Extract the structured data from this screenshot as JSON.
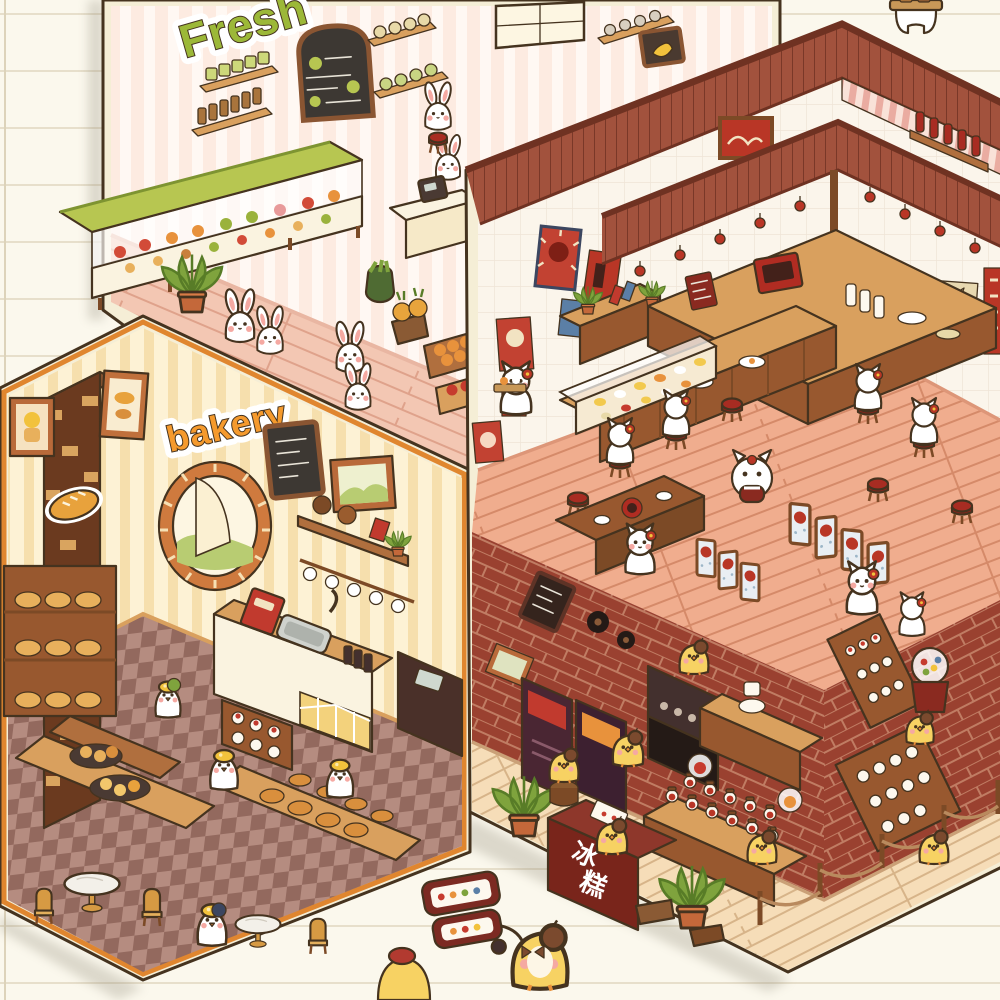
{
  "illustration": {
    "title": "Miniature animal shops",
    "style": "kawaii isometric watercolor rooms arranged on ruled notebook paper",
    "rooms_count": "4"
  },
  "paper": {
    "bg": "#fbf8ed",
    "rule_color": "#e7dfcb",
    "rule_spacing_px": "57",
    "margin_line_color": "#ddd3ba"
  },
  "palette": {
    "paper": "#fbf8ed",
    "rule": "#e7dfcb",
    "ink": "#45331f",
    "sticker": "#f5eed6",
    "market_wall": "#fdebe1",
    "market_stripe": "#fff8f3",
    "market_floor": "#f3c7b3",
    "market_plank": "#dfa28b",
    "green": "#b7c651",
    "green_lt": "#cdd87a",
    "green_dark": "#7e9431",
    "bakery_wall": "#fdf2d5",
    "bakery_stripe": "#f6dfad",
    "bakery_trim": "#e0862f",
    "check_a": "#93695e",
    "check_b": "#b58c80",
    "wood": "#b06f3e",
    "wood_dark": "#7c4a26",
    "wood_mid": "#98582f",
    "wood_light": "#d9a05e",
    "cream": "#faf3e0",
    "roof": "#a2523d",
    "roof_dark": "#6f3222",
    "awning_pink": "#eaaca1",
    "awning_lt": "#f9e2d8",
    "resto_wall": "#fbf5eb",
    "resto_tile": "#efe4d6",
    "resto_floor": "#f0ad8e",
    "resto_plank": "#d58a69",
    "poster": "#b93626",
    "stool": "#a82c22",
    "brick": "#9a4130",
    "mortar": "#c07c63",
    "candy_floor": "#f6ddb8",
    "candy_plank": "#d7b489",
    "freezer": "#79251b",
    "yolk": "#f2c23c",
    "chick": "#f7d263",
    "beret": "#7b4a2e",
    "blush": "#f5a9a2",
    "leaf": "#7fa33d",
    "leaf_dark": "#587c27",
    "white": "#ffffff",
    "marble": "#f3f0e9",
    "gold": "#d69a43",
    "dark_machine": "#43302e",
    "navy": "#3c4660"
  },
  "scenes": {
    "market": {
      "name": "Fresh grocery market",
      "sign": "Fresh",
      "sign_color": "#9cb838",
      "animals": "white rabbits",
      "features": [
        "produce display case",
        "chalkboard menu",
        "wall shelves with jars",
        "fruit crates and pineapples",
        "potted plants",
        "cash register"
      ]
    },
    "bakery": {
      "name": "Bakery cafe",
      "sign": "bakery",
      "sign_color": "#f59a2d",
      "animals": "white ducks with egg-yolk berets",
      "features": [
        "arched window with curtain",
        "brick pillar with bread decals",
        "coffee counter with sink",
        "bread display tables",
        "checkered floor",
        "marble cafe tables"
      ]
    },
    "restaurant": {
      "name": "Japanese izakaya restaurant",
      "animals": "white cats with red head flowers",
      "features": [
        "red plank roof",
        "bar canopy with hanging lanterns",
        "red stools",
        "folding screens",
        "red wall posters",
        "sushi display case",
        "hotpot table"
      ]
    },
    "snack_shop": {
      "name": "Retro snack and candy shop",
      "freezer_sign": "冰糕",
      "freezer_chars": [
        "冰",
        "糕"
      ],
      "animals": "yellow chicks with brown berets",
      "features": [
        "red brick walls",
        "candy jar island",
        "gumball machine",
        "arcade cabinets",
        "ice-cream freezer",
        "rope barrier",
        "potted palms"
      ]
    }
  },
  "foreground": {
    "description": "chick vendor with a two-tier snack cart on the notebook paper",
    "characters": [
      "chick with beret and bow tie pulling cart",
      "chick with red beret (partially cropped)"
    ]
  },
  "top_right": {
    "description": "white character carrying a wooden tray, cropped by the top edge"
  }
}
